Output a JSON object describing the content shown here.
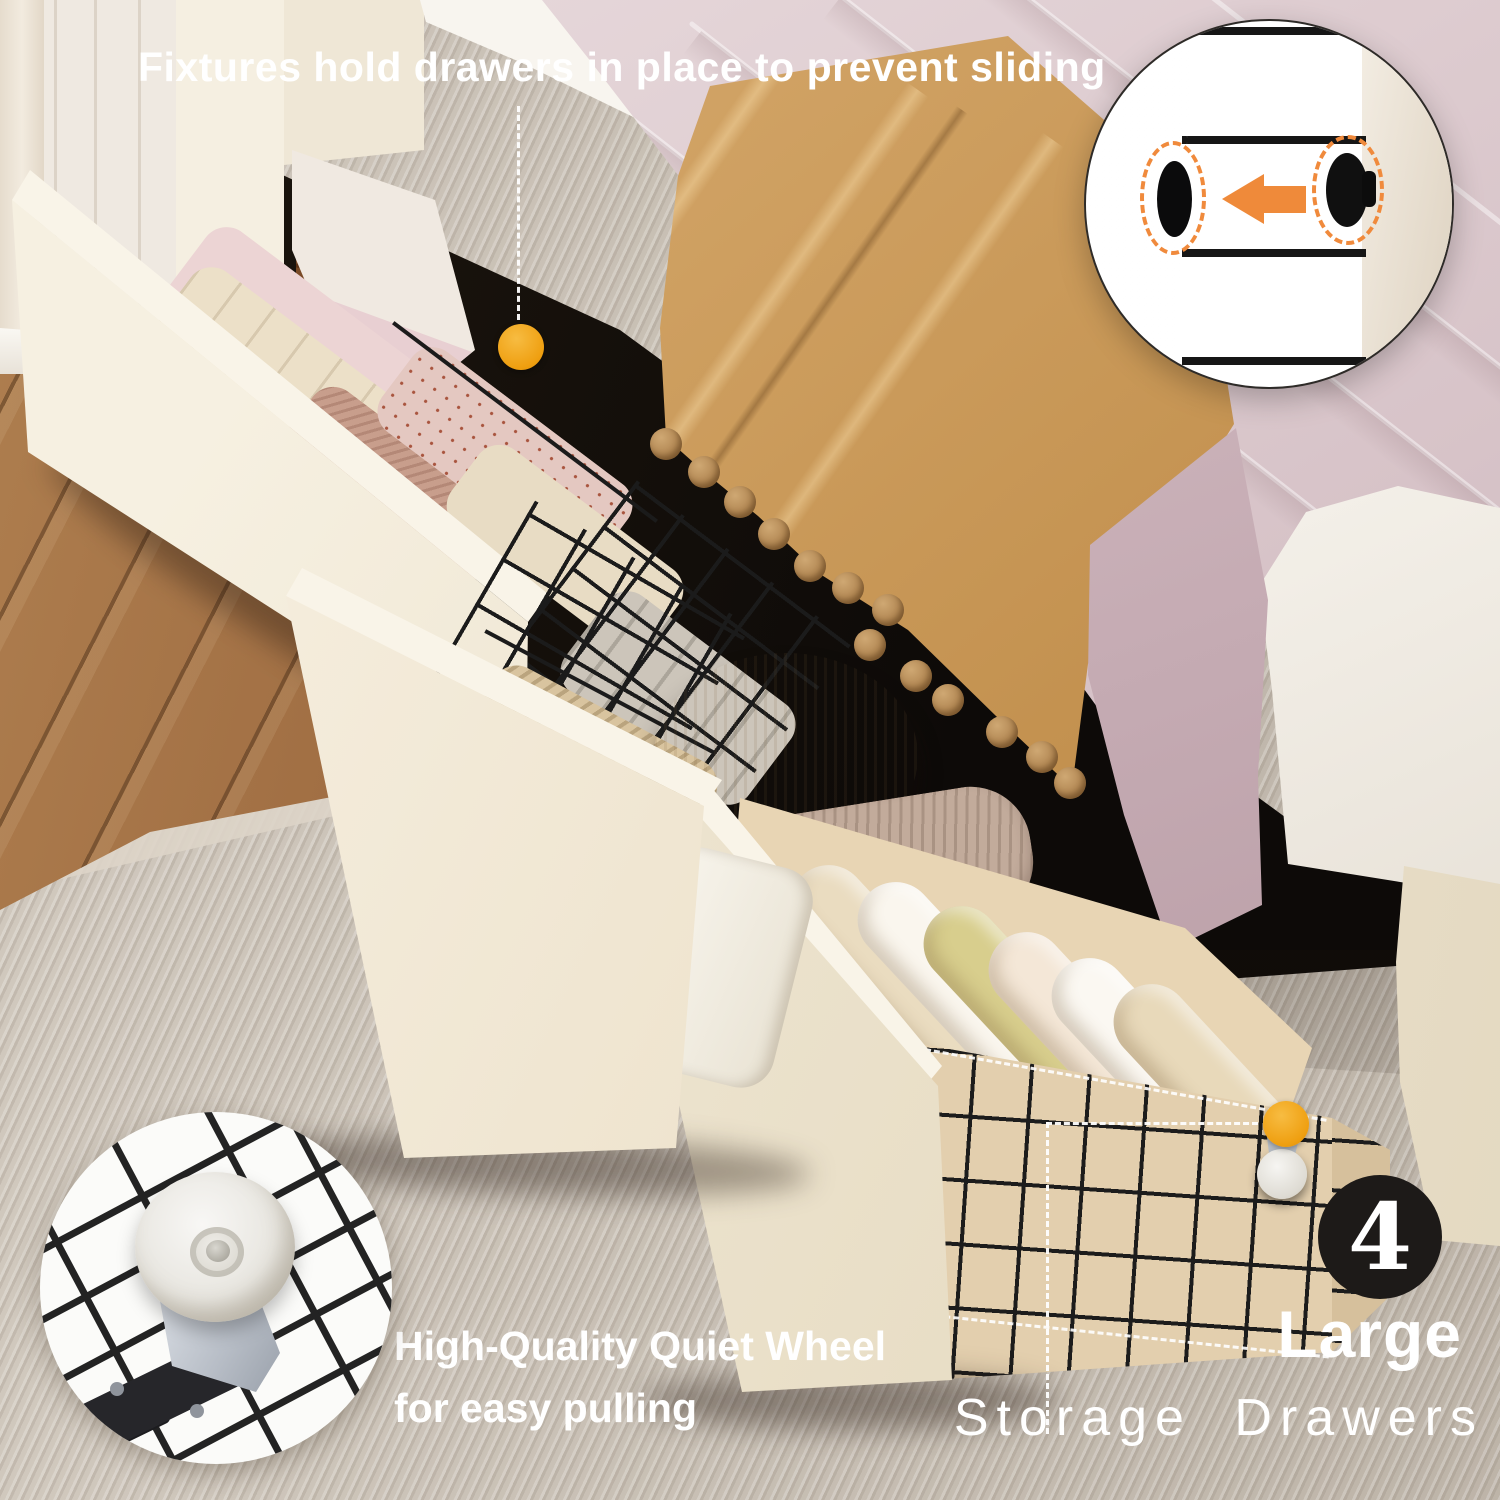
{
  "callouts": {
    "headline": "Fixtures hold drawers in place to prevent sliding",
    "wheel": {
      "line1": "High-Quality Quiet Wheel",
      "line2": "for easy pulling"
    },
    "count_badge": {
      "number": "4",
      "label_bold": "Large",
      "label_light": "Storage  Drawers"
    }
  },
  "icons": {
    "fixture_callout_dot": "orange-dot",
    "wheel_callout_dot": "orange-dot",
    "fixture_inset_arrow": "arrow-left",
    "fixture_inset_highlights": "dashed-ellipse"
  },
  "colors": {
    "accent_orange": "#F0A81C",
    "arrow_orange": "#EF8A3A",
    "badge_background": "#1D1A18",
    "text": "#FFFFFF",
    "drawer_cream": "#F3ECDD",
    "wire_black": "#1C1C1C",
    "rug": "#CBC2B6",
    "wood_floor": "#9A6A40",
    "tan_blanket": "#C79A5F",
    "comforter_mauve": "#D7C3C8"
  }
}
